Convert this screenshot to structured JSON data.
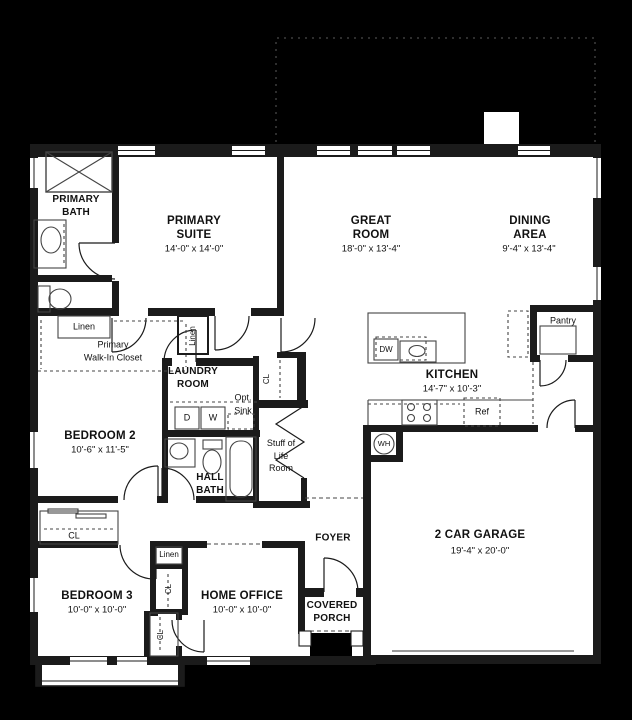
{
  "plan": {
    "background": "#000000",
    "floor_color": "#ffffff",
    "wall_color": "#1b1b1b",
    "dash_color": "#555555",
    "labels": [
      {
        "id": "primary-bath",
        "text": "PRIMARY\nBATH",
        "x": 76,
        "y": 207,
        "style": "name-sm"
      },
      {
        "id": "primary-suite",
        "text": "PRIMARY\nSUITE",
        "x": 194,
        "y": 229,
        "style": "name"
      },
      {
        "id": "primary-suite-dims",
        "text": "14'-0\" x 14'-0\"",
        "x": 194,
        "y": 249,
        "style": "dims"
      },
      {
        "id": "great-room",
        "text": "GREAT\nROOM",
        "x": 371,
        "y": 229,
        "style": "name"
      },
      {
        "id": "great-room-dims",
        "text": "18'-0\" x 13'-4\"",
        "x": 371,
        "y": 249,
        "style": "dims"
      },
      {
        "id": "dining-area",
        "text": "DINING\nAREA",
        "x": 530,
        "y": 229,
        "style": "name"
      },
      {
        "id": "dining-area-dims",
        "text": "9'-4\" x 13'-4\"",
        "x": 529,
        "y": 249,
        "style": "dims"
      },
      {
        "id": "linen-primary-bath",
        "text": "Linen",
        "x": 84,
        "y": 327,
        "style": "small"
      },
      {
        "id": "primary-walk-in-closet",
        "text": "Primary\nWalk-In Closet",
        "x": 113,
        "y": 351,
        "style": "small"
      },
      {
        "id": "linen-hall",
        "text": "Linen",
        "x": 193,
        "y": 336,
        "style": "xs",
        "rotate": true
      },
      {
        "id": "laundry-room",
        "text": "LAUNDRY\nROOM",
        "x": 193,
        "y": 379,
        "style": "name-sm"
      },
      {
        "id": "opt-sink",
        "text": "Opt.\nSink",
        "x": 243,
        "y": 404,
        "style": "small"
      },
      {
        "id": "dryer",
        "text": "D",
        "x": 187,
        "y": 418,
        "style": "small"
      },
      {
        "id": "washer",
        "text": "W",
        "x": 213,
        "y": 418,
        "style": "small"
      },
      {
        "id": "closet-laundry-hall",
        "text": "CL",
        "x": 267,
        "y": 379,
        "style": "xs",
        "rotate": true
      },
      {
        "id": "kitchen",
        "text": "KITCHEN",
        "x": 452,
        "y": 376,
        "style": "name"
      },
      {
        "id": "kitchen-dims",
        "text": "14'-7\" x 10'-3\"",
        "x": 452,
        "y": 389,
        "style": "dims"
      },
      {
        "id": "dishwasher",
        "text": "DW",
        "x": 386,
        "y": 350,
        "style": "xs"
      },
      {
        "id": "pantry",
        "text": "Pantry",
        "x": 563,
        "y": 321,
        "style": "small"
      },
      {
        "id": "bedroom-2",
        "text": "BEDROOM 2",
        "x": 100,
        "y": 437,
        "style": "name"
      },
      {
        "id": "bedroom-2-dims",
        "text": "10'-6\" x 11'-5\"",
        "x": 100,
        "y": 450,
        "style": "dims"
      },
      {
        "id": "stuff-of-life-room",
        "text": "Stuff of\nLife\nRoom",
        "x": 281,
        "y": 456,
        "style": "small"
      },
      {
        "id": "hall-bath",
        "text": "HALL\nBATH",
        "x": 210,
        "y": 485,
        "style": "name-sm"
      },
      {
        "id": "refrigerator",
        "text": "Ref",
        "x": 482,
        "y": 412,
        "style": "small"
      },
      {
        "id": "water-heater",
        "text": "WH",
        "x": 384,
        "y": 444,
        "style": "tiny"
      },
      {
        "id": "closet-hall",
        "text": "CL",
        "x": 74,
        "y": 536,
        "style": "small"
      },
      {
        "id": "foyer",
        "text": "FOYER",
        "x": 333,
        "y": 539,
        "style": "name-sm"
      },
      {
        "id": "garage",
        "text": "2 CAR GARAGE",
        "x": 480,
        "y": 536,
        "style": "name"
      },
      {
        "id": "garage-dims",
        "text": "19'-4\" x 20'-0\"",
        "x": 480,
        "y": 551,
        "style": "dims"
      },
      {
        "id": "linen-bedroom-3",
        "text": "Linen",
        "x": 169,
        "y": 555,
        "style": "xs"
      },
      {
        "id": "closet-bedroom-3",
        "text": "CL",
        "x": 169,
        "y": 589,
        "style": "xs",
        "rotate": true
      },
      {
        "id": "closet-home-office",
        "text": "CL",
        "x": 161,
        "y": 635,
        "style": "xs",
        "rotate": true
      },
      {
        "id": "bedroom-3",
        "text": "BEDROOM 3",
        "x": 97,
        "y": 597,
        "style": "name"
      },
      {
        "id": "bedroom-3-dims",
        "text": "10'-0\" x 10'-0\"",
        "x": 97,
        "y": 610,
        "style": "dims"
      },
      {
        "id": "home-office",
        "text": "HOME OFFICE",
        "x": 242,
        "y": 597,
        "style": "name"
      },
      {
        "id": "home-office-dims",
        "text": "10'-0\" x 10'-0\"",
        "x": 242,
        "y": 610,
        "style": "dims"
      },
      {
        "id": "covered-porch",
        "text": "COVERED\nPORCH",
        "x": 332,
        "y": 613,
        "style": "name-sm"
      }
    ]
  }
}
